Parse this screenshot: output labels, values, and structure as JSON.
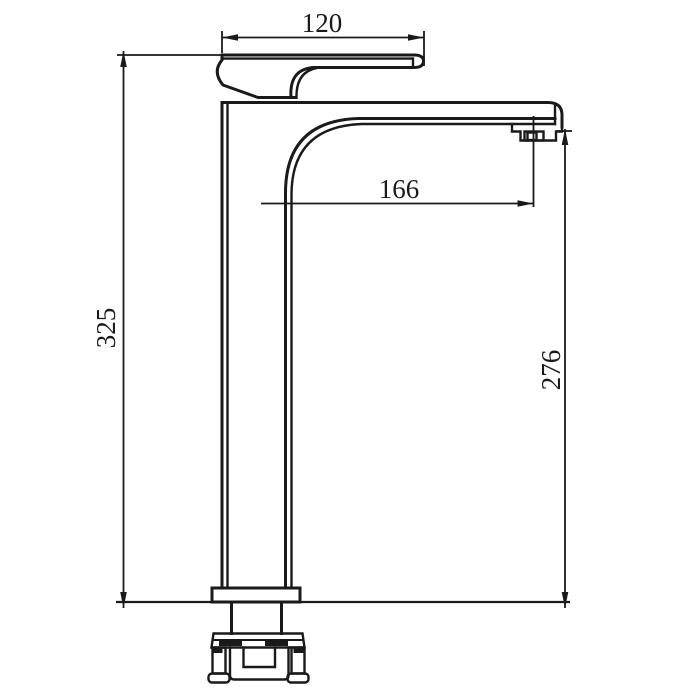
{
  "drawing": {
    "subject": "single-lever tall basin faucet, side elevation with dimensions",
    "colors": {
      "line": "#1a1a1a",
      "background": "#ffffff"
    },
    "dimensions": {
      "handle_length": "120",
      "overall_height": "325",
      "spout_reach": "166",
      "spout_outlet_height": "276"
    }
  }
}
